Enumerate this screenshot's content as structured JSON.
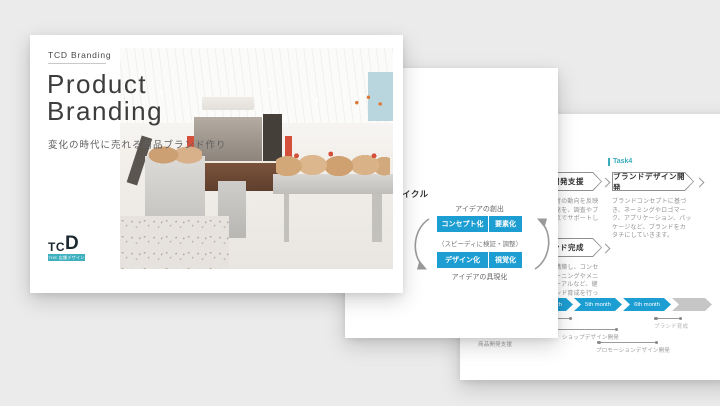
{
  "page": {
    "background": "#ebebeb"
  },
  "colors": {
    "accent_blue": "#1d9ed3",
    "accent_teal": "#3aadbc",
    "logo_bar": "#3fb0c0"
  },
  "slide1": {
    "eyebrow": "TCD Branding",
    "title_line1": "Product",
    "title_line2": "Branding",
    "subtitle": "変化の時代に売れる商品ブランド作り",
    "logo": {
      "tc": "TC",
      "d": "D",
      "tagline": "THE 店舗デザイン"
    },
    "photo_alt": "bakery-storefront-interior-photo"
  },
  "slide2": {
    "title": "開発サイクル",
    "cycle": {
      "top_label": "アイデアの創出",
      "row1": [
        "コンセプト化",
        "要素化"
      ],
      "middle_label": "（スピーディに検証・調整）",
      "row2": [
        "デザイン化",
        "視覚化"
      ],
      "bottom_label": "アイデアの具現化"
    }
  },
  "slide3": {
    "task_label": "Task4",
    "header1": "商品開発支援",
    "body1": "市場や生活者の動向を反映した商品開発を、調査やブランドの視点でサポートしていきます",
    "header2": "ブランドデザイン開発",
    "body2": "ブランドコンセプトに基づき、ネーミングやロゴマーク、アプリケーション、パッケージなど、ブランドをカタチにしていきます。",
    "header3": "ブランド完成",
    "body3": "ブランドを構築し、コンセプトのチューニングやメニューリニューアルなど、継続的なブランド育成を行っていきます",
    "timeline": {
      "months": [
        "3rd month",
        "4th month",
        "5th month",
        "6th month"
      ],
      "brackets": {
        "b1": "商品開発支援",
        "b2": "ショップデザイン開発",
        "b3": "プロモーションデザイン開発",
        "b4": "ブランド育成"
      }
    }
  }
}
